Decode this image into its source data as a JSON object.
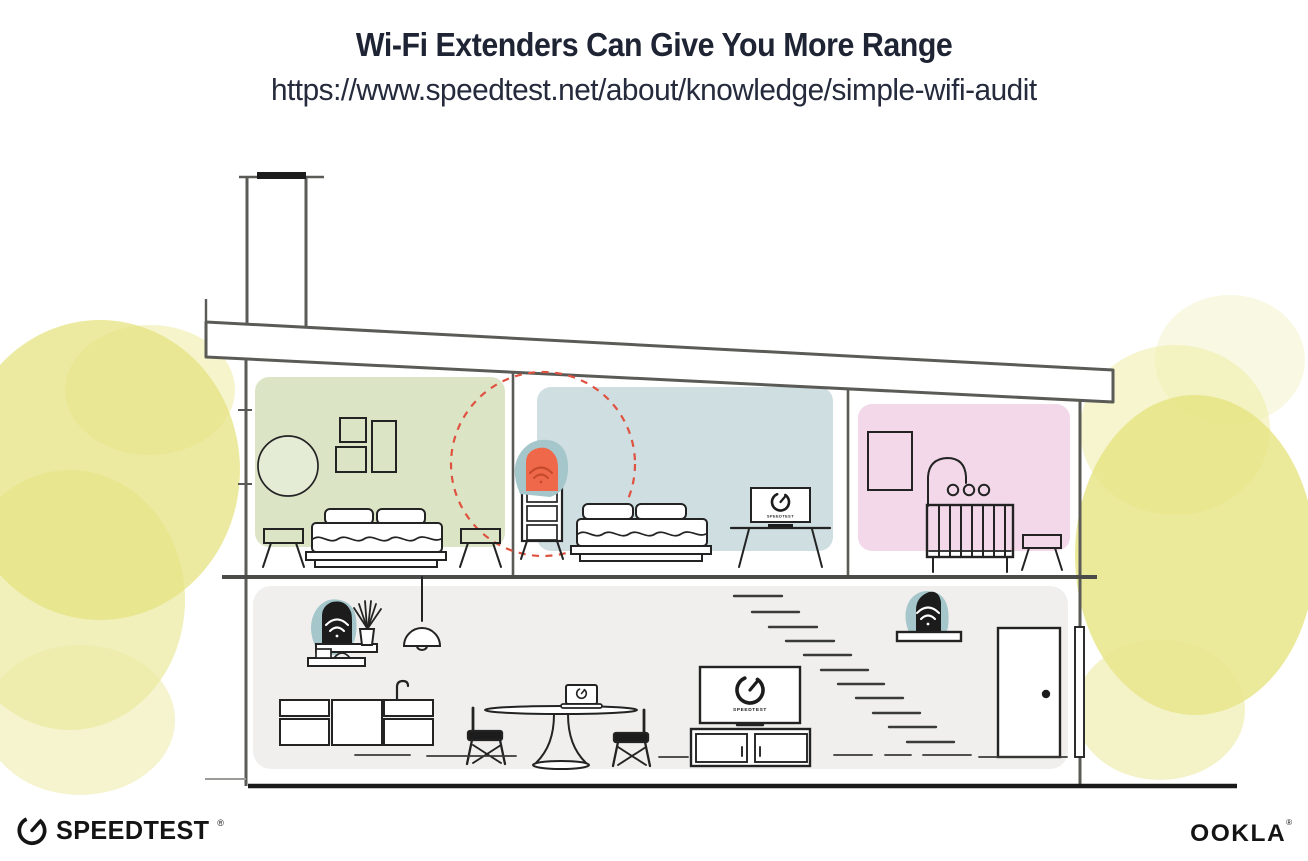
{
  "header": {
    "title": "Wi-Fi Extenders Can Give You More Range",
    "url": "https://www.speedtest.net/about/knowledge/simple-wifi-audit"
  },
  "diagram": {
    "description": "Cross-section of a two-story house showing a Wi-Fi router and Wi-Fi extenders improving coverage",
    "upper_rooms": [
      {
        "name": "green bedroom",
        "wall_color": "#dbe5c6",
        "furniture": [
          "round mirror",
          "picture frames",
          "bed",
          "two stools"
        ]
      },
      {
        "name": "blue bedroom",
        "wall_color": "#cfdee1",
        "furniture": [
          "dresser",
          "bed",
          "tv on stand"
        ],
        "device": "wifi extender",
        "range_circle_color": "#df5240"
      },
      {
        "name": "pink nursery",
        "wall_color": "#f3d8e9",
        "furniture": [
          "picture frame",
          "crib with mobile",
          "stool"
        ]
      }
    ],
    "lower_floor": {
      "wall_color": "#f0efed",
      "furniture": [
        "shelves",
        "plant",
        "pendant lamp",
        "kitchen counter",
        "dining table",
        "laptop",
        "two chairs",
        "tv on console",
        "stairs",
        "door"
      ],
      "devices": [
        "wifi router on shelf",
        "wifi extender on shelf"
      ]
    },
    "labels": {
      "tv_bedroom": "SPEEDTEST",
      "tv_living": "SPEEDTEST"
    },
    "accent_colors": {
      "extender_orange": "#f0684a",
      "extender_wifi": "#c54a2c",
      "device_black": "#1c1c1c",
      "device_halo_teal": "#a5c6ca",
      "range_dashed_red": "#df5240",
      "foliage_yellow": "#e6e381",
      "structure_gray": "#5a5a56",
      "ink": "#1e2434"
    }
  },
  "footer": {
    "speedtest_wordmark": "SPEEDTEST",
    "speedtest_reg": "®",
    "ookla_wordmark": "OOKLA",
    "ookla_reg": "®"
  }
}
